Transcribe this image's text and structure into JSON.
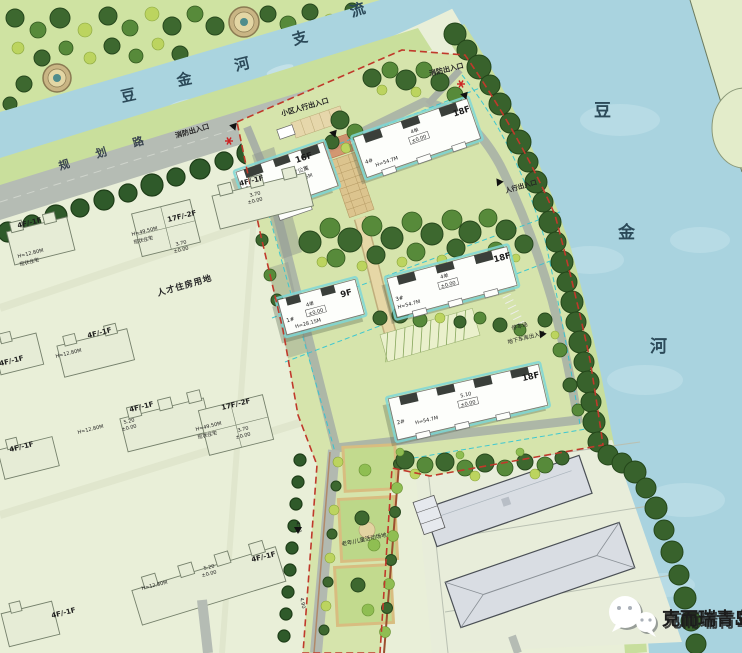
{
  "rivers": {
    "top": {
      "name": "豆金河支流",
      "chars": [
        "豆",
        "金",
        "河",
        "支",
        "流"
      ]
    },
    "east": {
      "name": "豆金河",
      "chars": [
        "豆",
        "金",
        "河"
      ]
    }
  },
  "roads": {
    "planning": {
      "name": "规划路",
      "chars": [
        "规",
        "划",
        "路"
      ]
    },
    "dims": [
      "4.30",
      "4.90"
    ]
  },
  "entrances": {
    "fire": "消防出入口",
    "community_pedestrian": "小区人行出入口",
    "pedestrian": "人行出入口",
    "garage": "地下车库出入口",
    "parking": "停车场"
  },
  "areas": {
    "talent_housing_land": "人才住房用地",
    "activity_ground": "老年/儿童活动场地"
  },
  "buildings": [
    {
      "id": "5#",
      "floors": "16F",
      "units": "4单",
      "use": "人才公寓",
      "height": "H=49.6M",
      "elev": "±0.00",
      "podium": "1-2F配套"
    },
    {
      "id": "4#",
      "floors": "18F",
      "units": "4单",
      "height": "H=54.7M",
      "elev": "±0.00"
    },
    {
      "id": "1#",
      "floors": "9F",
      "units": "4单",
      "height": "H=28.15M",
      "elev": "±0.00"
    },
    {
      "id": "3#",
      "floors": "18F",
      "units": "4单",
      "height": "H=54.7M",
      "elev": "±0.00"
    },
    {
      "id": "2#",
      "floors": "18F",
      "height": "H=54.7M",
      "elev": "±0.00",
      "fh": "5.10"
    }
  ],
  "west": {
    "low_label": "4F/-1F",
    "tower_label": "17F/-2F",
    "low_height": "H=12.80M",
    "tower_height": "H=49.50M",
    "type": "现状住宅",
    "fh": "3.70",
    "fh2": "5.20",
    "elev": "±0.00"
  },
  "watermark": {
    "label": "克而瑞青岛",
    "icon": "wechat-icon"
  },
  "colors": {
    "water": "#a9d3df",
    "land": "#e9efd8",
    "site": "#d6e4ac",
    "boundary_red": "#c0392b",
    "setback_cyan": "#2fc4d4"
  }
}
